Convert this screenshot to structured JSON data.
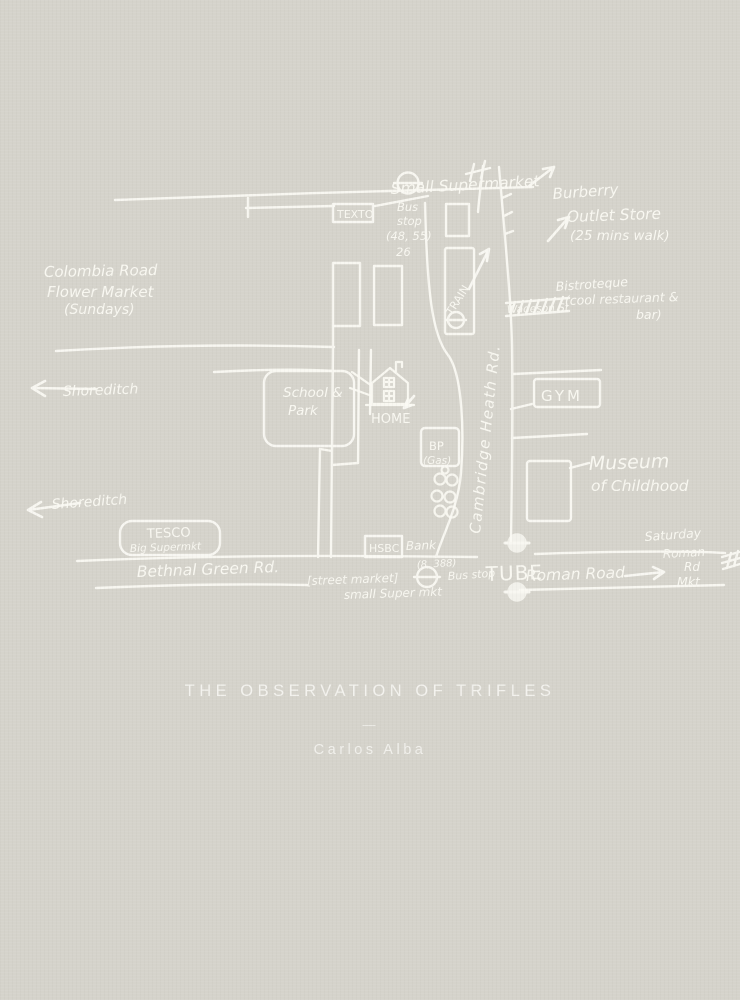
{
  "cover": {
    "background_color": "#d5d3cb",
    "ink_color": "#fbfaf4",
    "title": "THE OBSERVATION OF TRIFLES",
    "divider": "—",
    "author": "Carlos Alba"
  },
  "map": {
    "streets": {
      "bethnal_green_rd": "Bethnal Green Rd.",
      "cambridge_heath_rd": "Cambridge Heath Rd.",
      "roman_road": "Roman Road",
      "wadeson_st": "Wadeson St",
      "shoreditch_upper": "Shoreditch",
      "shoreditch_lower": "Shoreditch"
    },
    "places": {
      "small_supermarket_top": "Small Supermarket",
      "burberry": [
        "Burberry",
        "Outlet Store",
        "(25 mins walk)"
      ],
      "texto": "TEXTO",
      "bus_stop_top": [
        "Bus",
        "stop",
        "(48, 55)",
        "26"
      ],
      "colombia_market": [
        "Colombia Road",
        "Flower Market",
        "(Sundays)"
      ],
      "bistroteque": [
        "Bistroteque",
        "(cool restaurant &",
        "bar)"
      ],
      "train": "TRAIN",
      "school_park": [
        "School &",
        "Park"
      ],
      "home": "HOME",
      "gym": "GYM",
      "museum": [
        "Museum",
        "of Childhood"
      ],
      "bp": [
        "BP",
        "(Gas)"
      ],
      "tesco": [
        "TESCO",
        "Big Supermkt"
      ],
      "hsbc": "HSBC",
      "bank": "Bank",
      "bus_routes_bottom": "(8, 388)",
      "bus_stop_bottom": "Bus stop",
      "tube": "TUBE",
      "saturday_market": [
        "Saturday",
        "Roman",
        "Rd",
        "Mkt"
      ],
      "street_market": "[street market]",
      "small_super_mkt": "small Super mkt"
    }
  }
}
